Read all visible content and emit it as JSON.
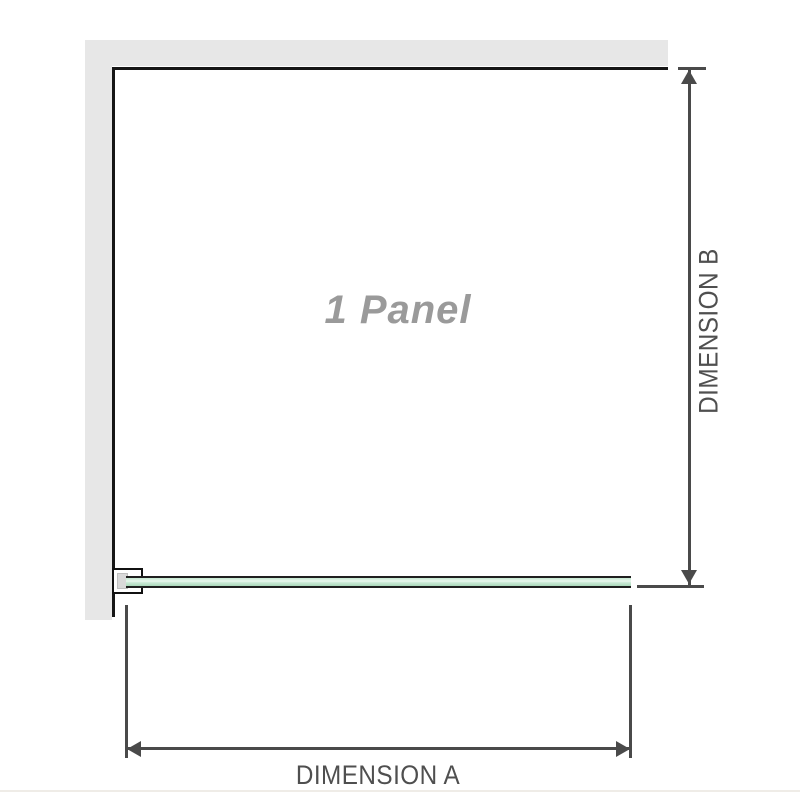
{
  "diagram": {
    "type": "shower-screen-plan-dimension-diagram",
    "panel_label": "1 Panel",
    "dimension_a": {
      "label": "DIMENSION A",
      "orientation": "horizontal",
      "measures": "panel width along bottom"
    },
    "dimension_b": {
      "label": "DIMENSION B",
      "orientation": "vertical",
      "measures": "enclosure depth along right side"
    },
    "colors": {
      "wall_fill": "#e7e7e7",
      "screen_outline": "#161616",
      "dimension_line": "#4a4a4a",
      "dimension_text": "#4f4f4f",
      "glass_fill_light": "#e9f7ee",
      "glass_fill_dark": "#a9d8ba",
      "glass_border": "#1f1f1f",
      "panel_label_gray": "#9a9a9a",
      "bracket_spacer_fill": "#d9d9d9",
      "footer_rule": "#efece7"
    }
  }
}
